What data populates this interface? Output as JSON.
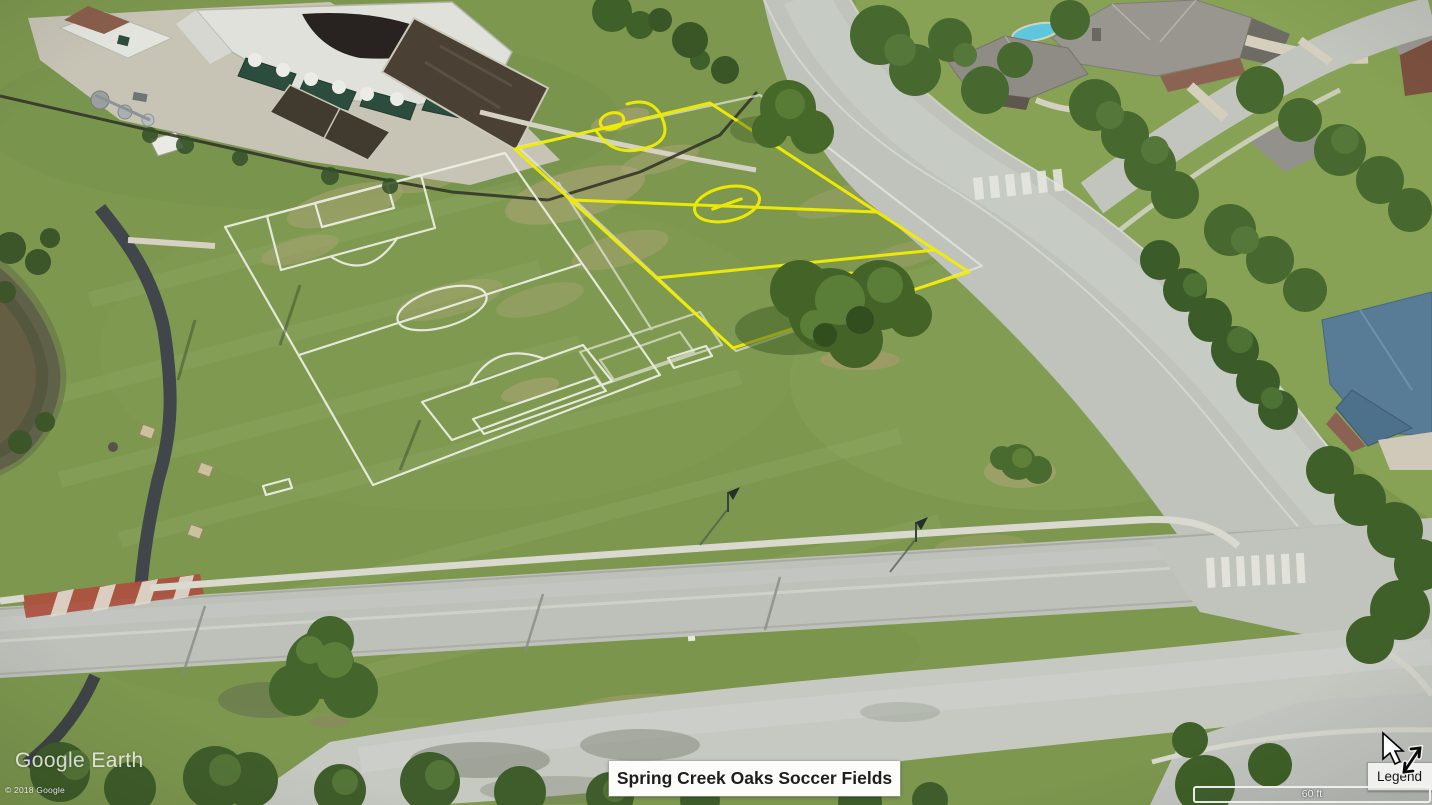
{
  "app": {
    "watermark": "Google Earth",
    "copyright": "© 2018 Google"
  },
  "map": {
    "placemark_label": "Spring Creek Oaks Soccer Fields",
    "scale_label": "60 ft",
    "colors": {
      "highlight_field_outline": "#f2ee00",
      "painted_field_lines": "#eef0e6",
      "grass": "#7d974f",
      "road": "#bfc3bc",
      "canal_water": "#5f6149",
      "red_path": "#ad4f3f"
    }
  },
  "controls": {
    "legend_label": "Legend"
  }
}
